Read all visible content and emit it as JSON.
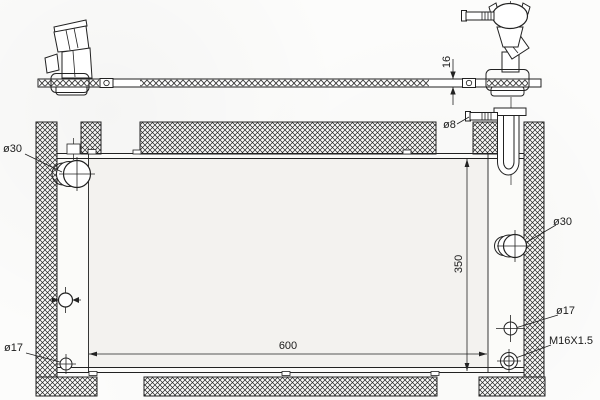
{
  "labels": {
    "inlet_left_diameter": "ø30",
    "mount_hole_left_diameter": "ø17",
    "overflow_pipe_diameter": "ø8",
    "outlet_right_diameter": "ø30",
    "mount_hole_right_diameter": "ø17",
    "drain_plug_thread": "M16X1.5",
    "core_width": "600",
    "core_height": "350",
    "core_thickness": "16"
  },
  "colors": {
    "line": "#222222",
    "paper": "#fcfcfb",
    "core_fill": "#f3f2ef"
  }
}
